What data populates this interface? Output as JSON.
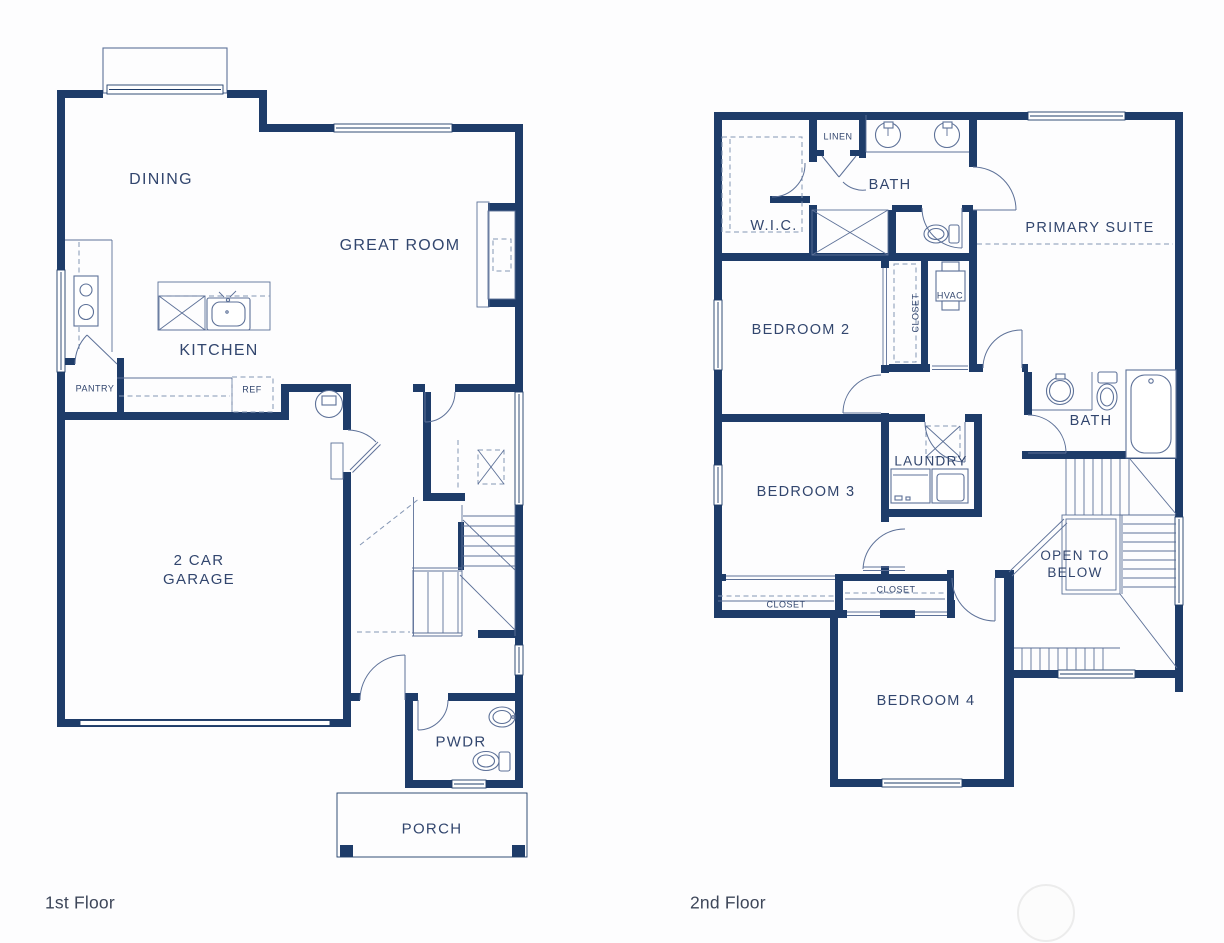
{
  "document": {
    "type": "residential floor plan, two levels"
  },
  "colors": {
    "wall": "#1e3c69",
    "line": "#5d7198",
    "soft": "#8496b4",
    "label": "#32466e",
    "title": "#3d4659",
    "background": "#fdfdfe",
    "watermark": "#ececec"
  },
  "floor1": {
    "title": "1st Floor",
    "rooms": {
      "dining": "DINING",
      "great_room": "GREAT ROOM",
      "kitchen": "KITCHEN",
      "pantry": "PANTRY",
      "ref": "REF",
      "garage": "2 CAR\nGARAGE",
      "pwdr": "PWDR",
      "porch": "PORCH"
    }
  },
  "floor2": {
    "title": "2nd Floor",
    "rooms": {
      "linen": "LINEN",
      "bath_upper": "BATH",
      "wic": "W.I.C.",
      "primary_suite": "PRIMARY SUITE",
      "bedroom2": "BEDROOM 2",
      "closet_bedroom2": "CLOSET",
      "hvac": "HVAC",
      "bedroom3": "BEDROOM 3",
      "laundry": "LAUNDRY",
      "bath_hall": "BATH",
      "open_below": "OPEN TO\nBELOW",
      "closet_bedroom3": "CLOSET",
      "closet_hall": "CLOSET",
      "bedroom4": "BEDROOM 4"
    }
  }
}
